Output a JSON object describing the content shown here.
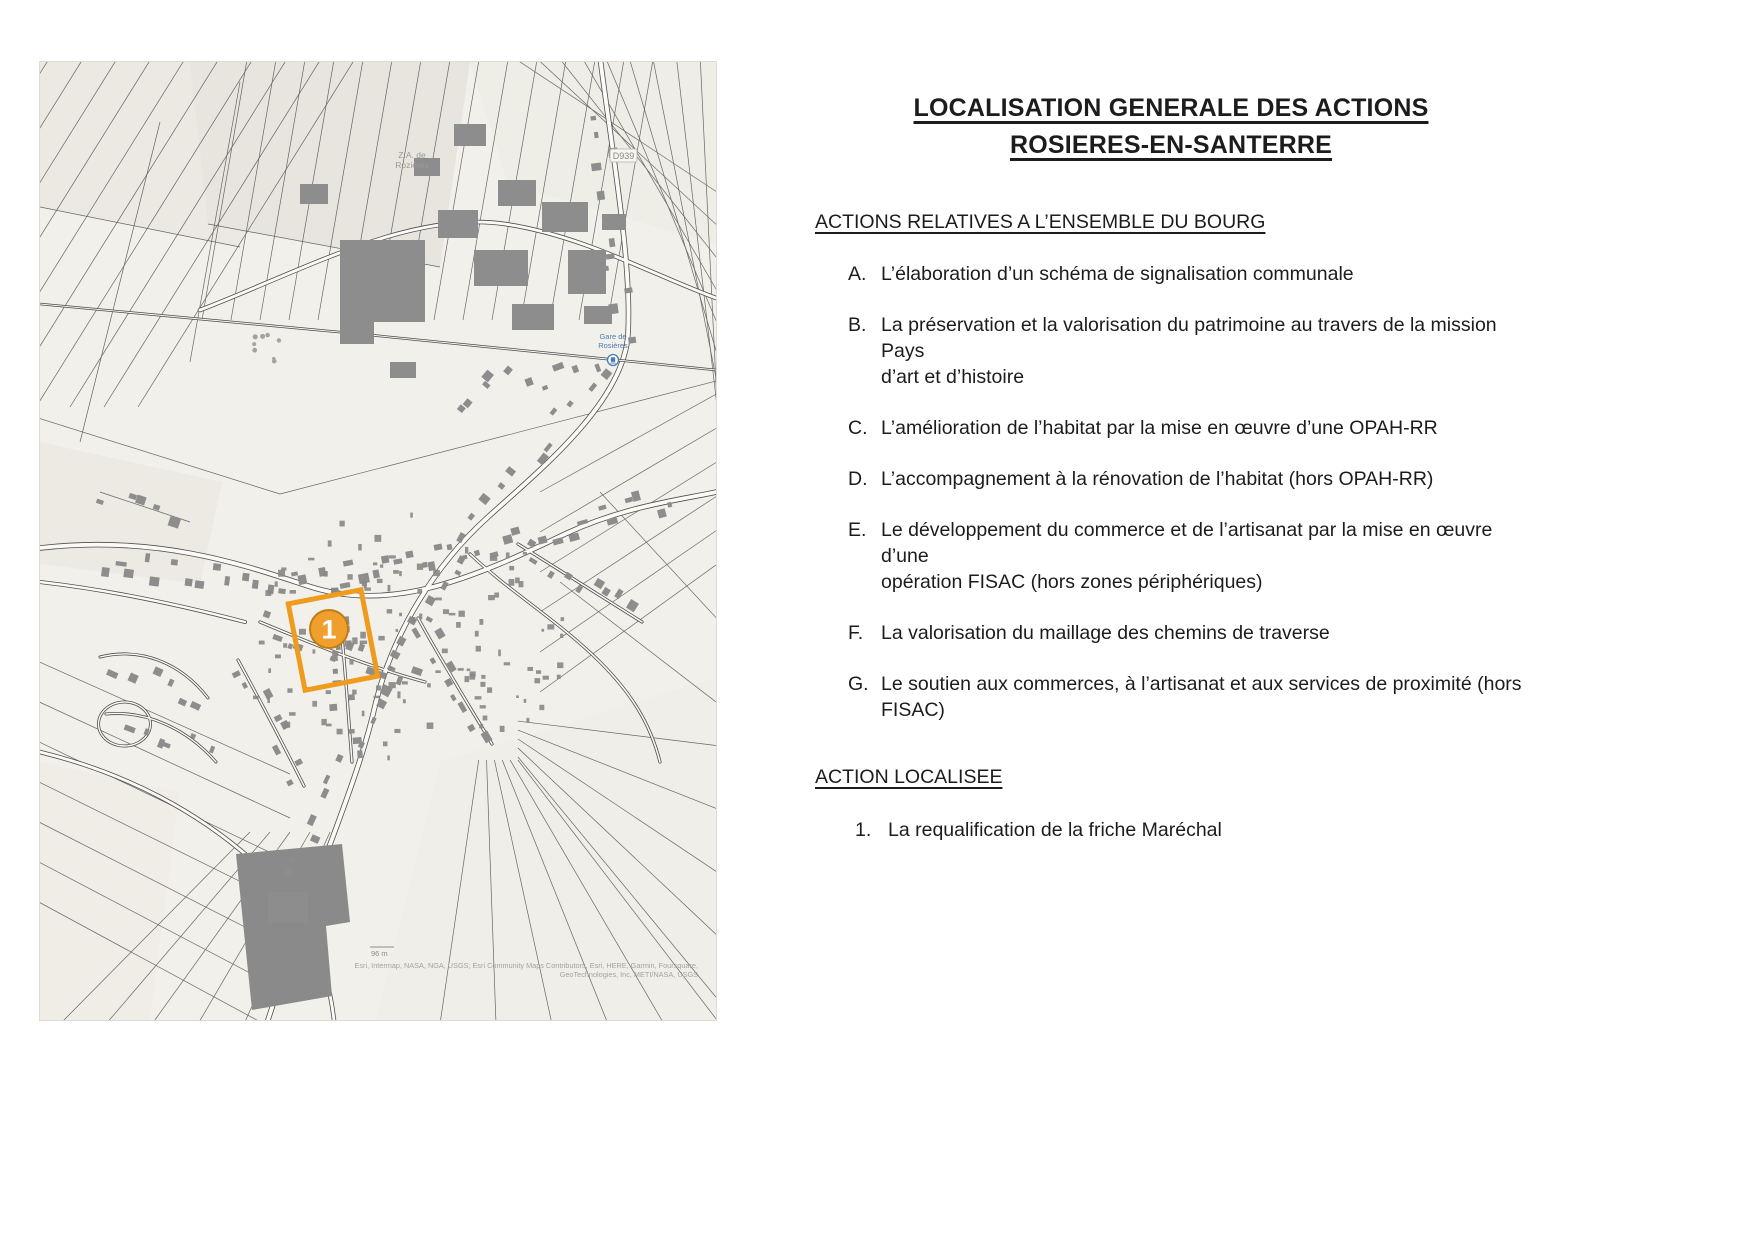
{
  "title": {
    "line1": "LOCALISATION GENERALE DES ACTIONS",
    "line2": "ROSIERES-EN-SANTERRE"
  },
  "sections": {
    "bourg": {
      "heading": "ACTIONS RELATIVES A L’ENSEMBLE DU BOURG",
      "items": [
        {
          "label": "A.",
          "lines": [
            "L’élaboration d’un schéma de signalisation communale"
          ]
        },
        {
          "label": "B.",
          "lines": [
            "La préservation et la valorisation du patrimoine au travers de la mission Pays",
            "d’art et d’histoire"
          ]
        },
        {
          "label": "C.",
          "lines": [
            "L’amélioration de l’habitat par la mise en œuvre d’une OPAH-RR"
          ]
        },
        {
          "label": "D.",
          "lines": [
            "L’accompagnement à la rénovation de l’habitat (hors OPAH-RR)"
          ]
        },
        {
          "label": "E.",
          "lines": [
            "Le développement du commerce et de l’artisanat par la mise en œuvre d’une",
            "opération FISAC (hors zones périphériques)"
          ]
        },
        {
          "label": "F.",
          "lines": [
            "La valorisation du maillage des chemins de traverse"
          ]
        },
        {
          "label": "G.",
          "lines": [
            "Le soutien aux commerces, à l’artisanat et aux services de proximité (hors",
            "FISAC)"
          ]
        }
      ]
    },
    "localisee": {
      "heading": "ACTION LOCALISEE",
      "items": [
        {
          "label": "1.",
          "lines": [
            "La requalification de la friche Maréchal"
          ]
        }
      ]
    }
  },
  "map": {
    "marker": {
      "number": "1",
      "color": "#EE9B1E"
    },
    "labels": {
      "za_line1": "Z.A. de",
      "za_line2": "Rozières",
      "route_shield": "D939",
      "gare_line1": "Gare de",
      "gare_line2": "Rosières",
      "scale": "96 m",
      "attribution_line1": "Esri, Intermap, NASA, NGA, USGS; Esri Community Maps Contributors, Esri, HERE, Garmin, Foursquare,",
      "attribution_line2": "GeoTechnologies, Inc, METI/NASA, USGS"
    }
  }
}
